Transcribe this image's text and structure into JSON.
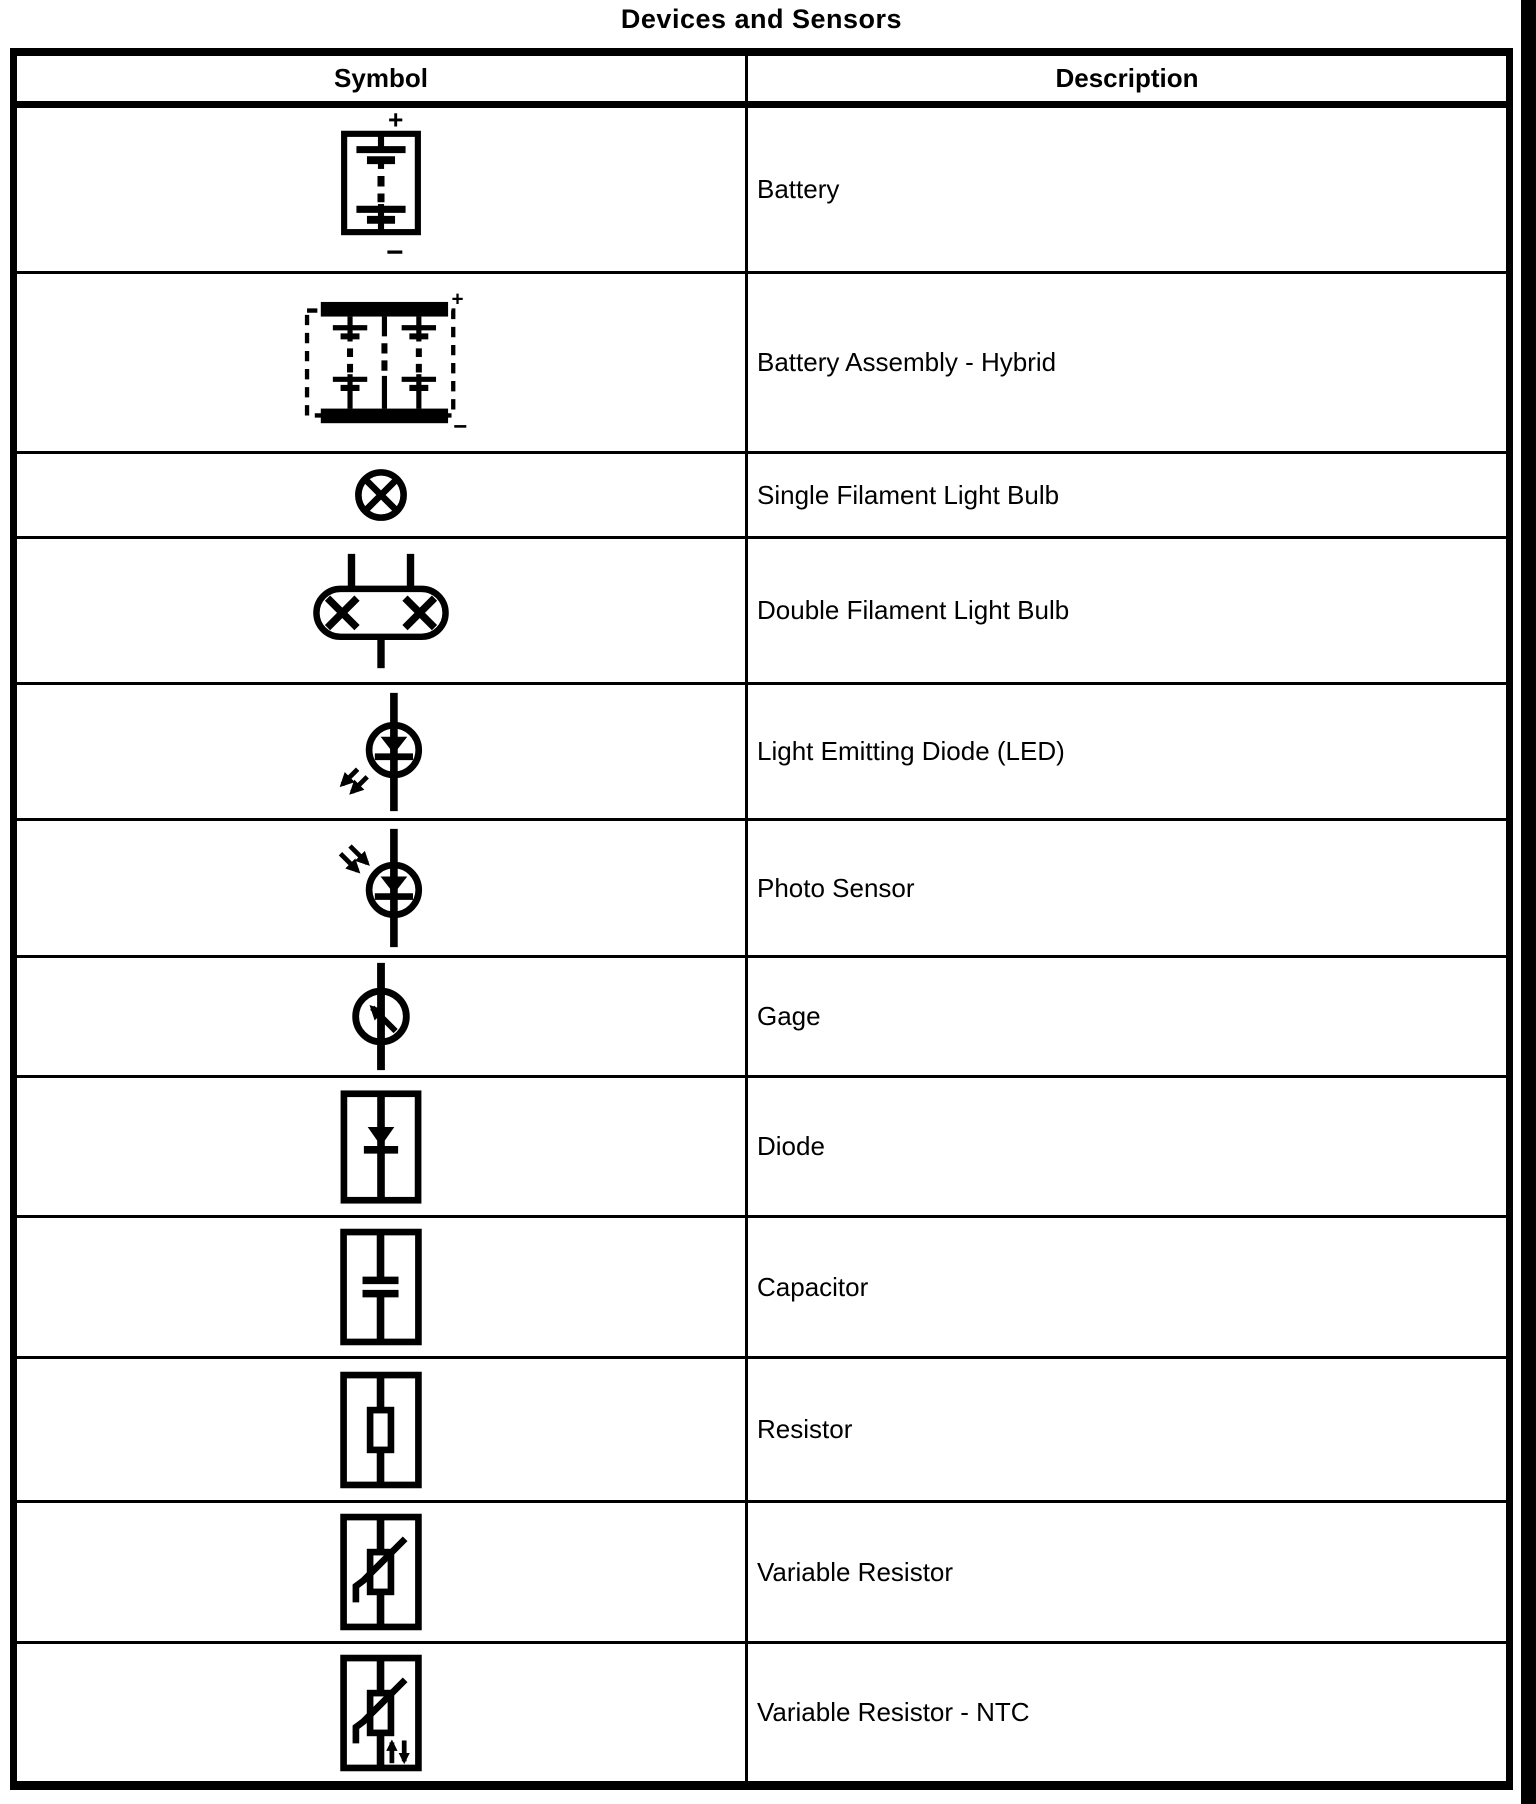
{
  "title": "Devices and Sensors",
  "colors": {
    "ink": "#000000",
    "paper": "#ffffff"
  },
  "table": {
    "col_symbol": "Symbol",
    "col_description": "Description",
    "rows": [
      {
        "name": "battery",
        "description": "Battery",
        "labels": {
          "plus": "+",
          "minus": "−"
        }
      },
      {
        "name": "battery-assembly-hybrid",
        "description": "Battery Assembly - Hybrid",
        "labels": {
          "plus": "+",
          "minus": "−"
        }
      },
      {
        "name": "single-filament-light-bulb",
        "description": "Single Filament Light Bulb"
      },
      {
        "name": "double-filament-light-bulb",
        "description": "Double Filament Light Bulb"
      },
      {
        "name": "light-emitting-diode",
        "description": "Light Emitting Diode (LED)"
      },
      {
        "name": "photo-sensor",
        "description": "Photo Sensor"
      },
      {
        "name": "gage",
        "description": "Gage"
      },
      {
        "name": "diode",
        "description": "Diode"
      },
      {
        "name": "capacitor",
        "description": "Capacitor"
      },
      {
        "name": "resistor",
        "description": "Resistor"
      },
      {
        "name": "variable-resistor",
        "description": "Variable Resistor"
      },
      {
        "name": "variable-resistor-ntc",
        "description": "Variable Resistor - NTC"
      }
    ]
  }
}
